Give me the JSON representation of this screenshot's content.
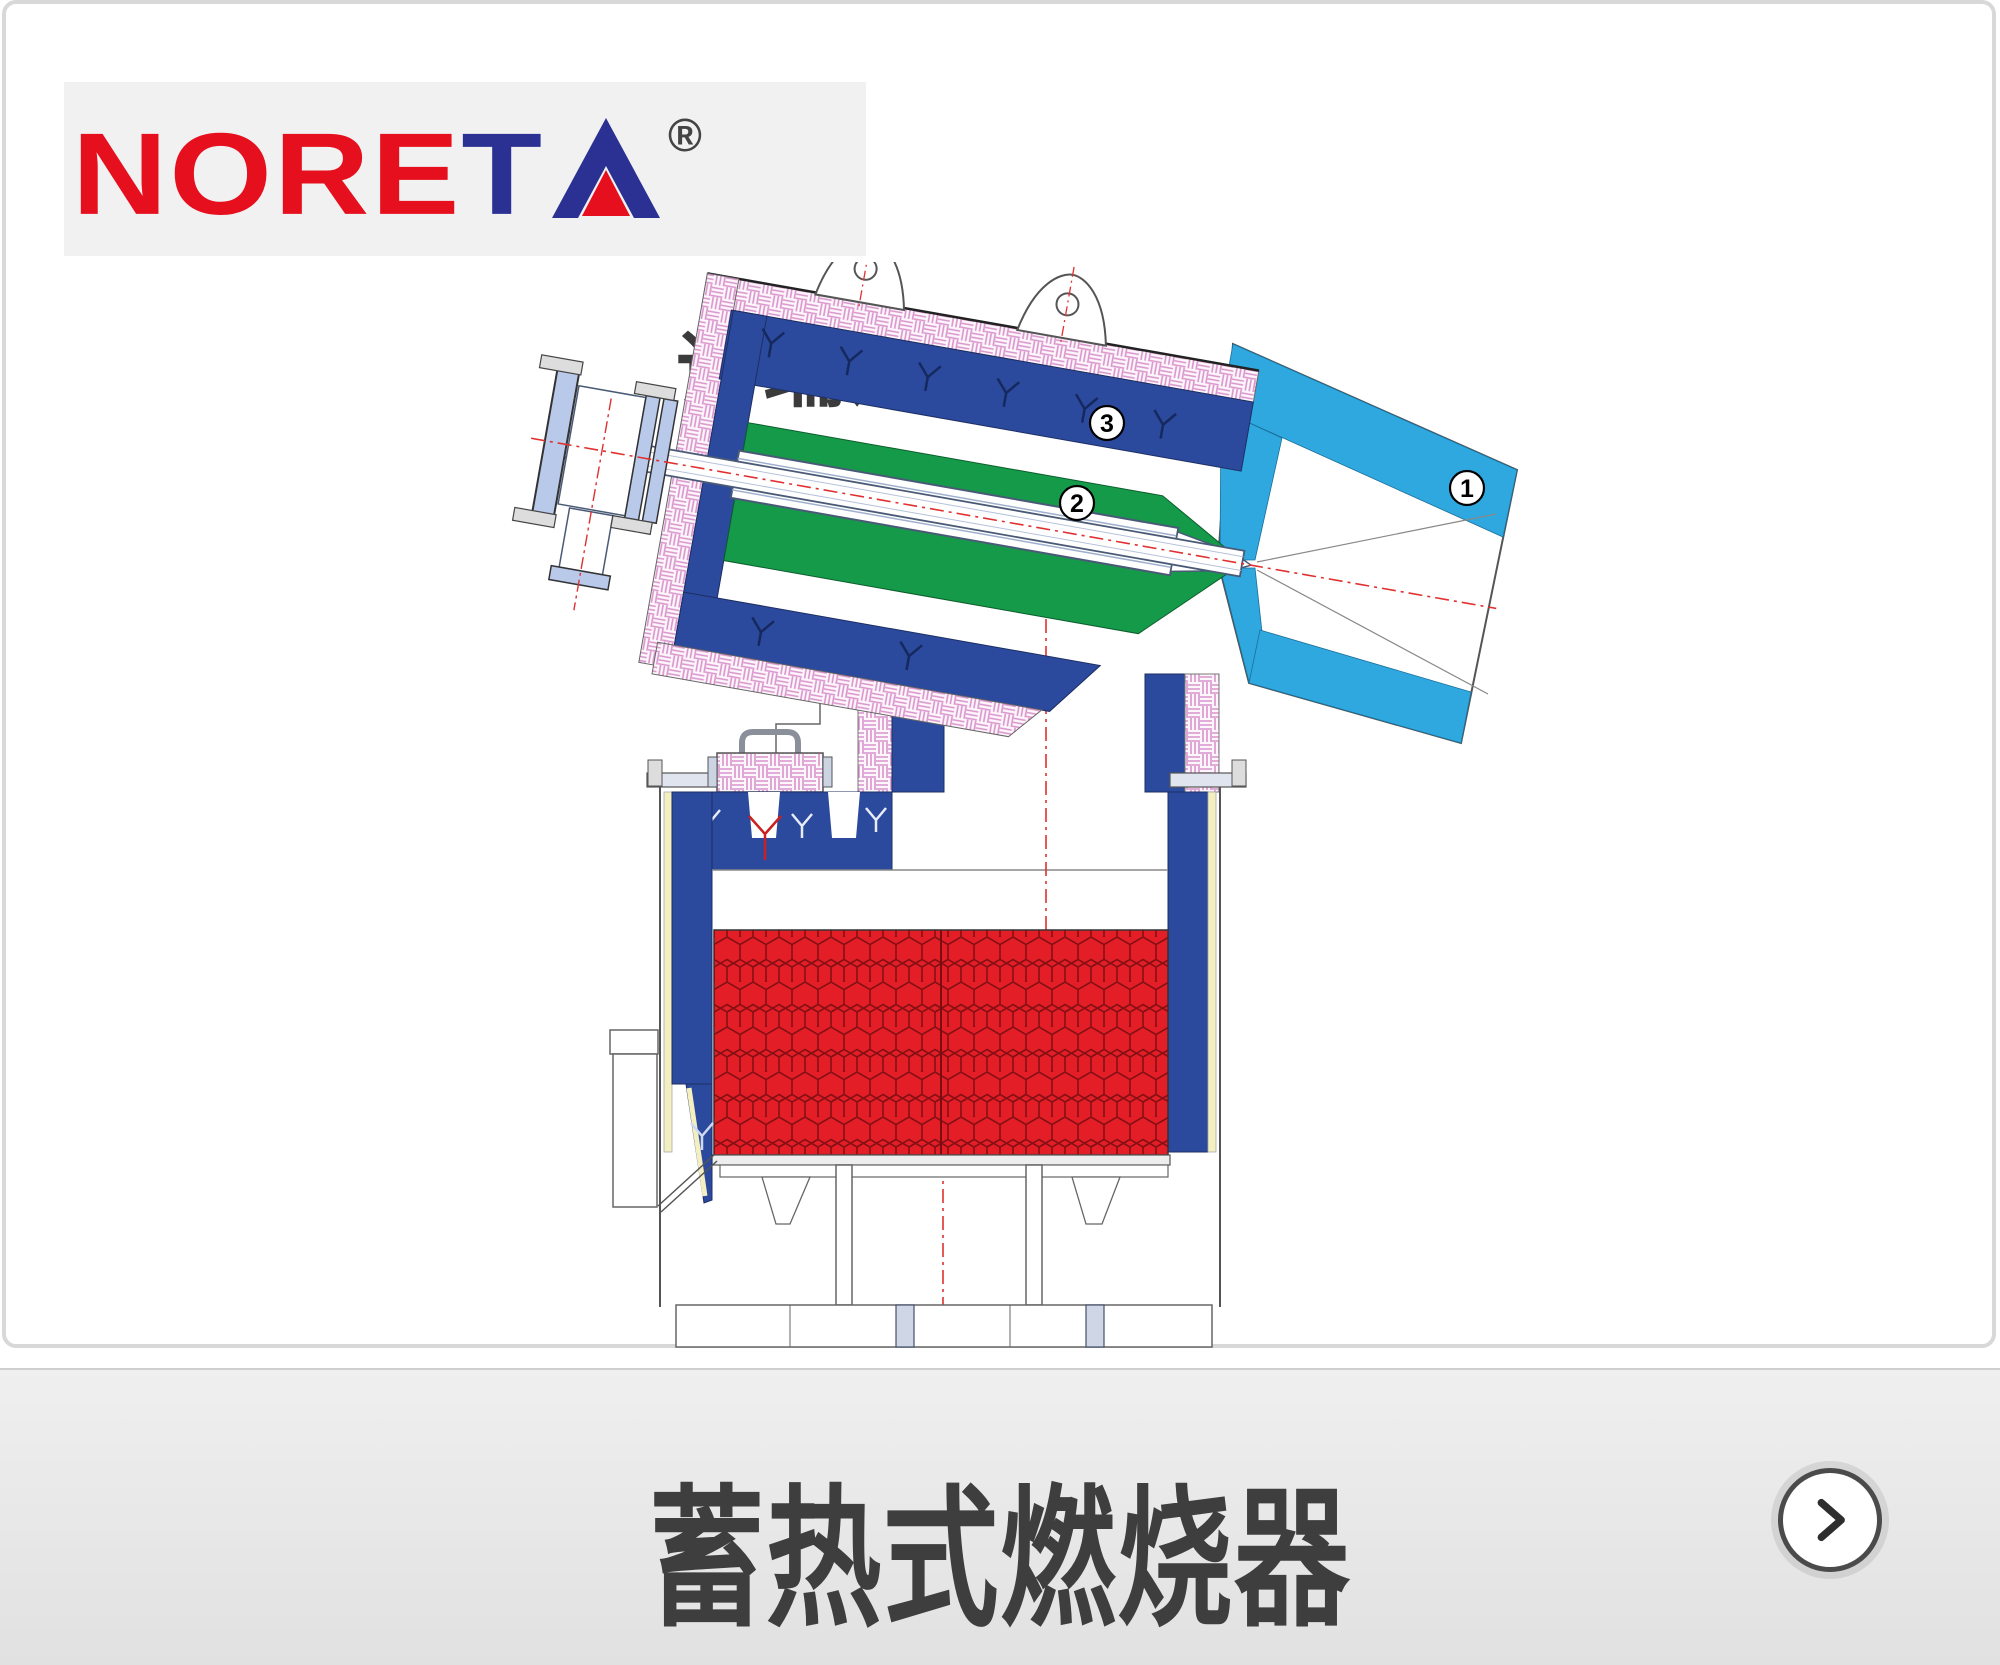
{
  "logo": {
    "brand": "NORETA",
    "brand_red": "NORE",
    "brand_t": "T",
    "brand_a": "A",
    "registered": "®",
    "chinese": "诺瑞达",
    "color_red": "#e60f1d",
    "color_navy": "#2a3193",
    "box_bg": "#f1f1f2"
  },
  "footer": {
    "title": "蓄热式燃烧器",
    "next_icon": "chevron-right"
  },
  "diagram": {
    "description": "regenerative-burner-cross-section",
    "callouts": [
      {
        "num": "1",
        "part": "nozzle-block"
      },
      {
        "num": "2",
        "part": "air-gas-lance-channel"
      },
      {
        "num": "3",
        "part": "burner-lining"
      }
    ],
    "colors": {
      "lining_blue": "#2b4a9d",
      "channel_green": "#159a4a",
      "nozzle_skyblue": "#2fa8e0",
      "honeycomb_red": "#e31e26",
      "insulation_pink": "#d993cc",
      "insulation_yellow": "#f3efc0",
      "centerline_red": "#e03030"
    }
  }
}
